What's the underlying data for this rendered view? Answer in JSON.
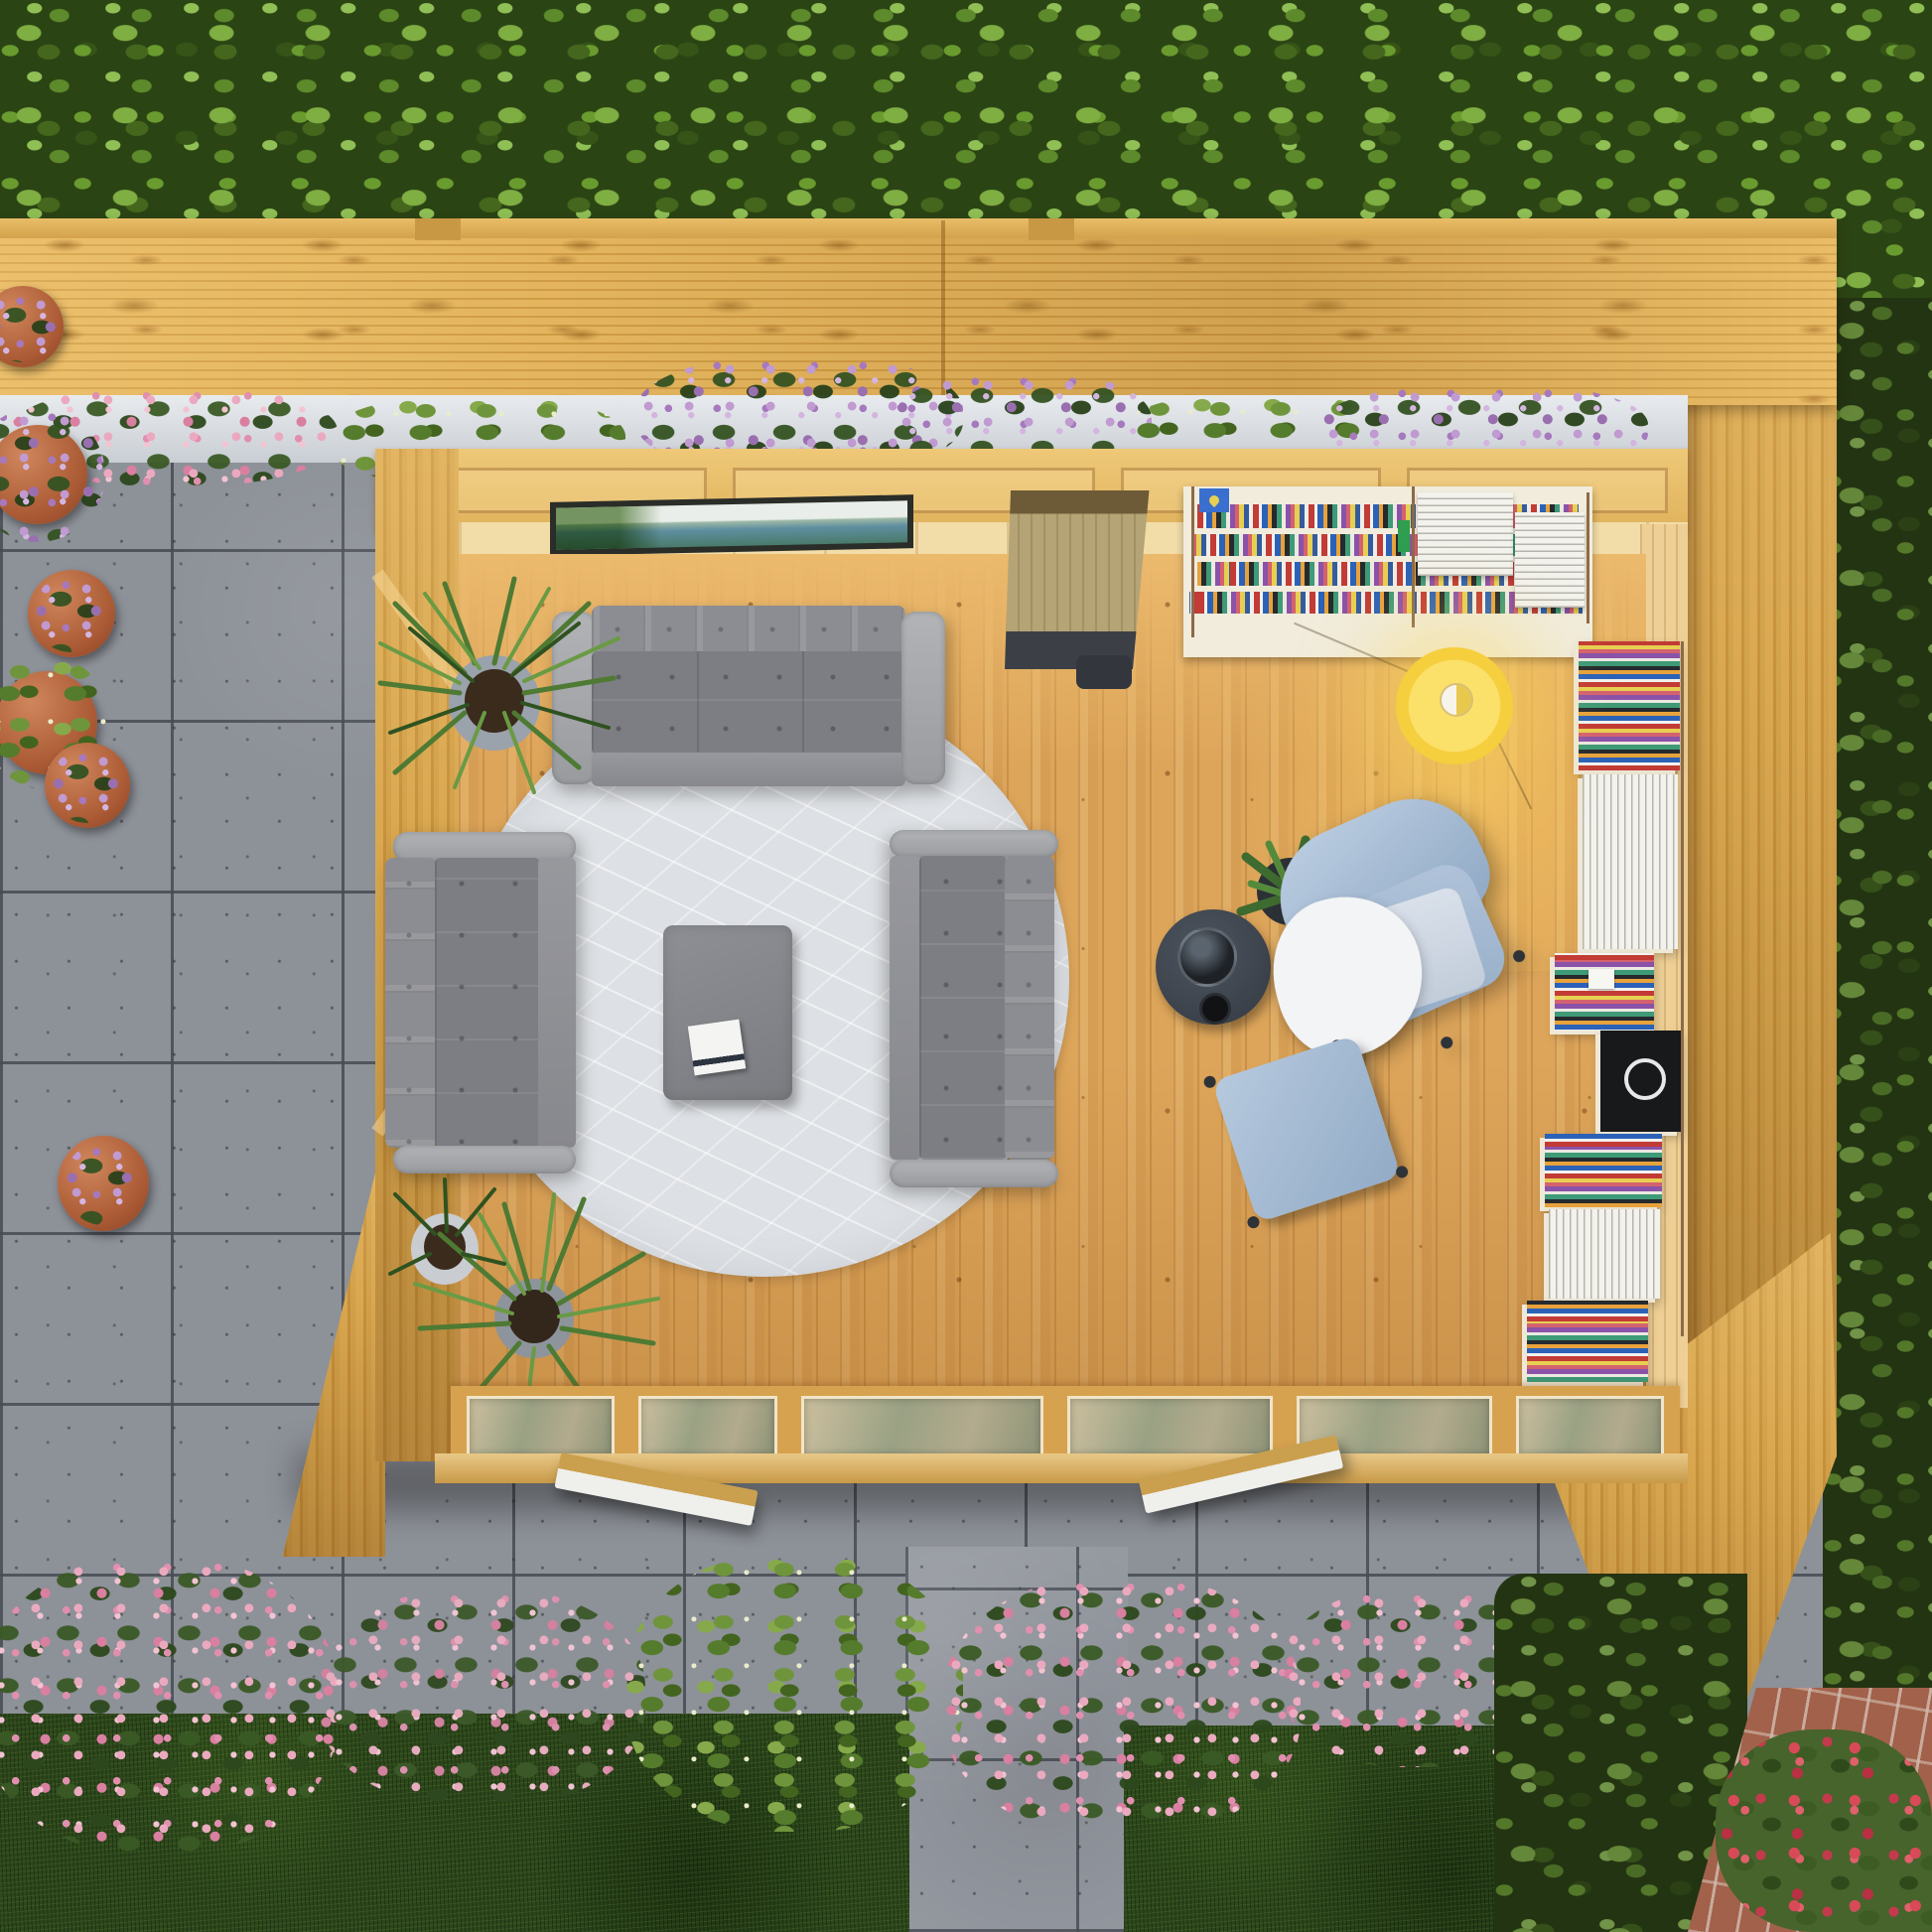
{
  "scene": {
    "type": "3d-render",
    "view": "top-down aerial",
    "title": "Top-down 3D render of a timber garden room used as a reading lounge, on a grey patio surrounded by hedges, lawn, flower beds and potted plants",
    "time_of_day": "daylight",
    "text_content": "none - the image contains no visible text or UI"
  },
  "palette": {
    "hedge_green": "#3c5c1c",
    "lawn_green": "#2c471b",
    "patio_grey": "#8d9198",
    "timber_light": "#e9c075",
    "timber_deck": "#d9a64e",
    "timber_deep": "#c08a32",
    "floor_wood": "#dda55a",
    "sofa_grey": "#7d7e83",
    "rug_grey": "#dde0e4",
    "armchair_blue": "#a9bed6",
    "footstool_blue": "#9fb6d0",
    "lamp_yellow": "#f7d44a",
    "shelf_cream": "#f1ecdc",
    "side_table_charcoal": "#3e454e",
    "flower_pink": "#e8a7b8",
    "flower_purple": "#b78cc9",
    "rose_red": "#d84a57",
    "terracotta": "#b8643c",
    "brick": "#a2614a",
    "window_frame_dark": "#2a2d28"
  },
  "environment": {
    "hedge_top": "dense bright-green hedge across the top of the garden",
    "hedge_right": "darker hedge running down the right boundary",
    "deck_band": "slatted timber pergola / roof band spanning the garden above the room",
    "roof_overhang_right": "timber roof and wall slab wrapping the top-right corner of the room",
    "planter_row": {
      "description": "white window-box planters with pink and purple flowers along the room's rear wall",
      "flower_colors": [
        "#e8a7b8",
        "#b78cc9"
      ]
    },
    "patio": "large square grey stone slabs surrounding the building",
    "garden_path": "grey slab path leading away from the doors at bottom centre",
    "lawn": "two panels of dark green lawn at the bottom",
    "flower_bed_bottom": "bed of pink flowering shrubs and one yellow-green bush between patio and lawn",
    "potted_plants_left": [
      {
        "pot": "terracotta",
        "flowers": "purple"
      },
      {
        "pot": "terracotta",
        "flowers": "purple trailing"
      },
      {
        "pot": "terracotta",
        "flowers": "purple"
      },
      {
        "pot": "terracotta",
        "flowers": "white-green foliage"
      },
      {
        "pot": "terracotta",
        "flowers": "purple"
      },
      {
        "pot": "terracotta",
        "flowers": "purple"
      }
    ],
    "shrub_bottom_right": "dark leafy shrub at lower right",
    "brick_corner": "red brick paving wedge in the bottom-right corner",
    "roses_bottom_right": "rose bush with red blooms at bottom-right"
  },
  "garden_room": {
    "structure": {
      "walls": "light pine tongue-and-groove seen from above, left wall with diagonal braces",
      "clerestory_window": {
        "description": "long narrow window in the rear wall reflecting pale sky and green hills",
        "frame_color": "#2a2d28"
      },
      "glazed_front": "row of six glazed window and door panels along the bottom wall",
      "open_sashes": 2,
      "floor": "vertical pine planks with warm lamp light pooling at the right"
    },
    "furniture": [
      {
        "name": "three-seat sofa",
        "color": "#7d7e83",
        "position": "top edge of rug, facing centre"
      },
      {
        "name": "two-seat sofa left",
        "color": "#7d7e83",
        "position": "left edge of rug"
      },
      {
        "name": "two-seat sofa right",
        "color": "#7d7e83",
        "position": "right edge of rug"
      },
      {
        "name": "round rug",
        "color": "#dde0e4",
        "pattern": "white leaf-vein lines"
      },
      {
        "name": "ottoman coffee table",
        "color": "#85868b",
        "item_on_top": "book"
      },
      {
        "name": "desk unit",
        "description": "wood desk with dark leather back band and charcoal chair tucked beneath, against rear wall"
      },
      {
        "name": "rear wall bookshelf",
        "description": "cream string-style shelving with colourful book spines, white book stacks, brass side rails, blue book with yellow heart cover"
      },
      {
        "name": "right wall bookshelf",
        "description": "tall shelving column with colourful spines, white stacks, small white laptop and a black album with white S logo"
      },
      {
        "name": "pendant lamp",
        "color": "#f7d44a",
        "state": "lit, casting warm glow"
      },
      {
        "name": "swivel armchair",
        "color": "#a9bed6",
        "extras": [
          "white throw blanket",
          "pale cushion",
          "casters"
        ]
      },
      {
        "name": "footstool",
        "color": "#9fb6d0"
      },
      {
        "name": "side table",
        "color": "#3e454e",
        "items": [
          "glass teapot",
          "small black bowl"
        ]
      },
      {
        "name": "dracaena plant",
        "position": "interior top-left corner",
        "pot": "grey"
      },
      {
        "name": "dracaena plant",
        "position": "interior bottom-left corner",
        "pot": "grey"
      },
      {
        "name": "snake plant",
        "position": "beside armchair",
        "pot": "black"
      }
    ]
  }
}
